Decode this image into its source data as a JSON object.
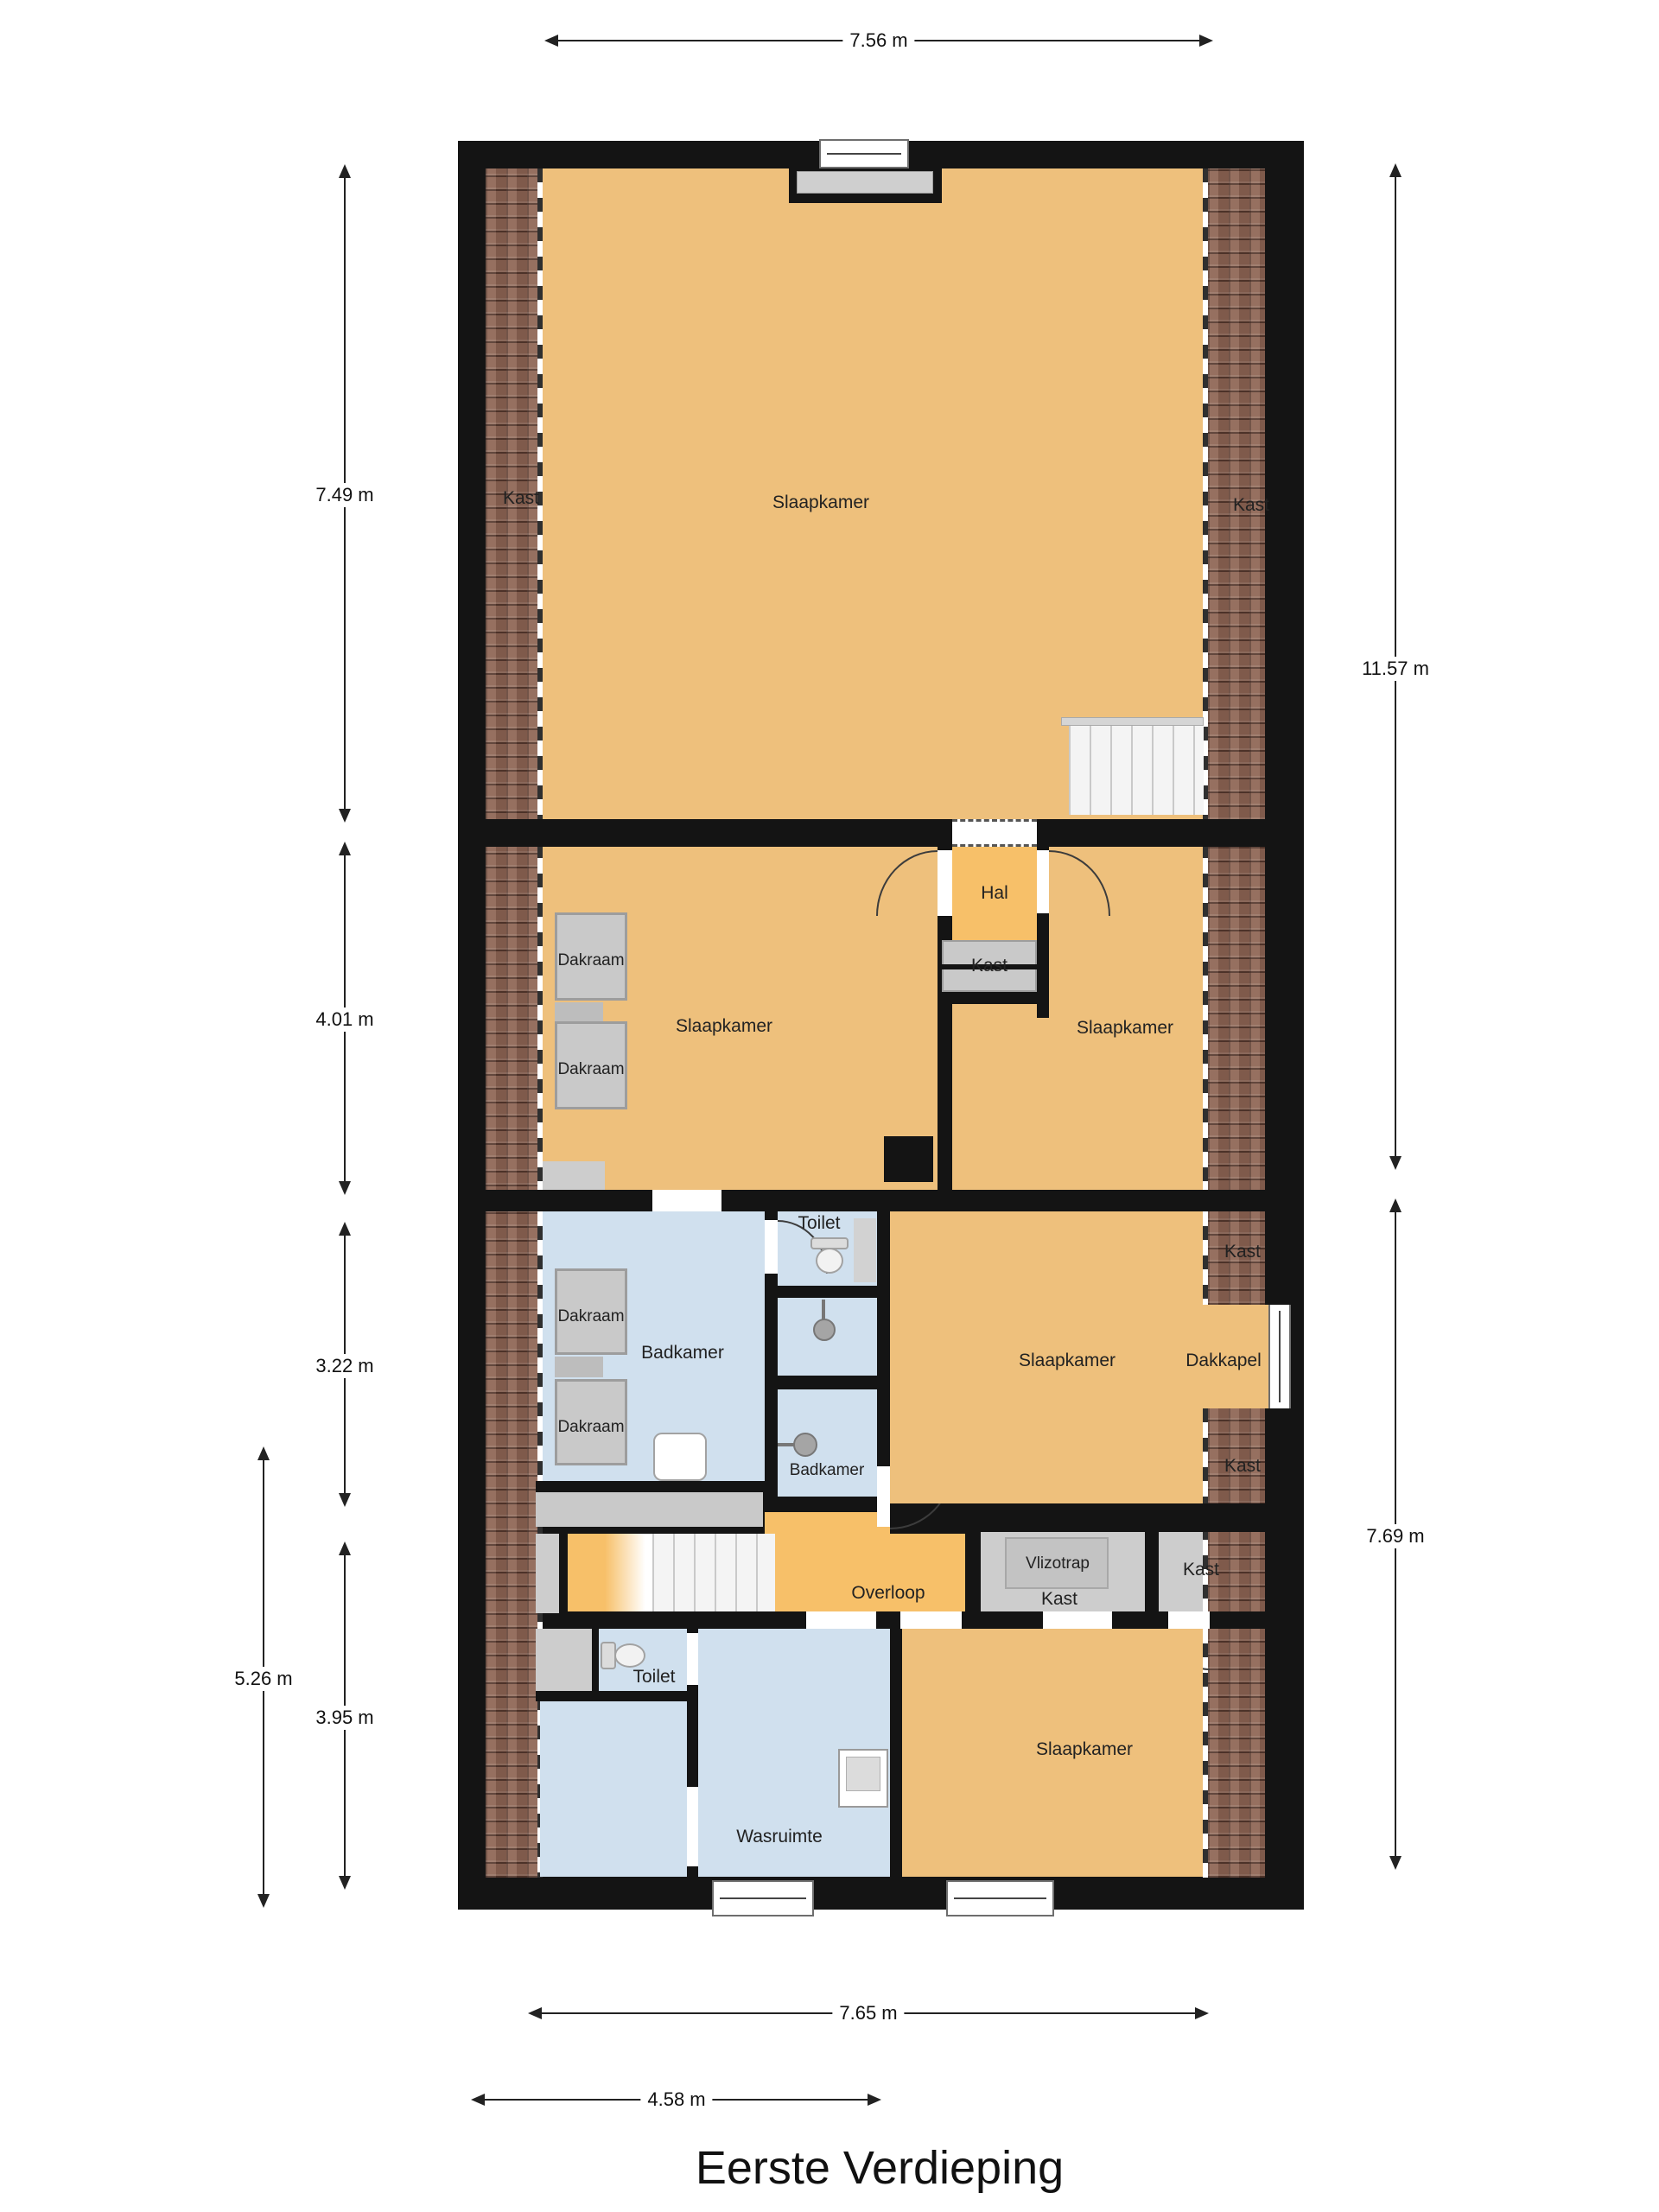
{
  "title": "Eerste Verdieping",
  "labels": {
    "slaapkamer": "Slaapkamer",
    "hal": "Hal",
    "kast": "Kast",
    "dakraam": "Dakraam",
    "badkamer": "Badkamer",
    "toilet": "Toilet",
    "overloop": "Overloop",
    "wasruimte": "Wasruimte",
    "vlizotrap": "Vlizotrap",
    "dakkapel": "Dakkapel"
  },
  "dimensions": {
    "top_width": "7.56 m",
    "left_upper": "7.49 m",
    "left_middle": "4.01 m",
    "left_bath": "3.22 m",
    "left_lower_outer": "5.26 m",
    "left_lower": "3.95 m",
    "right_upper": "11.57 m",
    "right_lower": "7.69 m",
    "bottom_width": "7.65 m",
    "bottom_left_width": "4.58 m"
  },
  "colors": {
    "bedroom_orange": "#eec07c",
    "hall_orange": "#f7c069",
    "bath_blue": "#d0e0ee",
    "closet_gray": "#cdcdcd",
    "roof_brown": "#8d6453",
    "wall_black": "#141414"
  }
}
